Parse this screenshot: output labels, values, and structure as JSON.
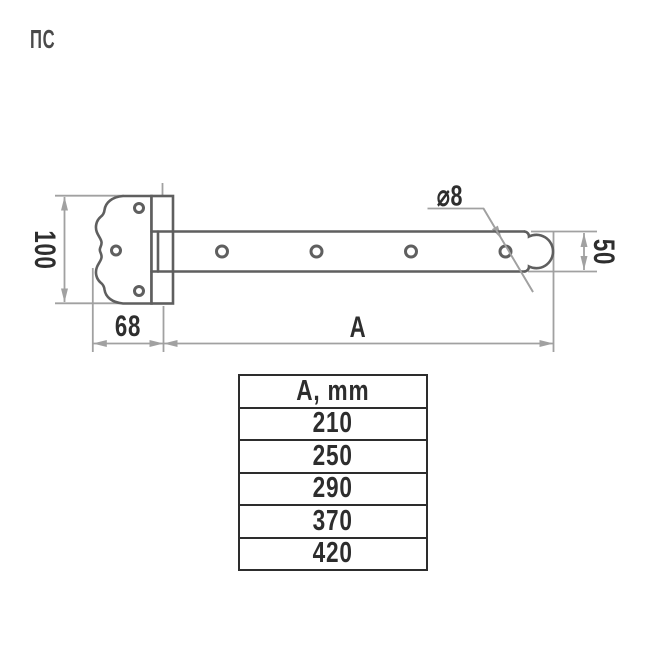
{
  "product_code": "ПС",
  "drawing": {
    "kind": "strap hinge technical drawing",
    "dimensions": {
      "plate_height": "100",
      "plate_width": "68",
      "strap_length_label": "А",
      "strap_width": "50",
      "hole_diameter": "⌀8"
    }
  },
  "table": {
    "header": "А, mm",
    "rows": [
      "210",
      "250",
      "290",
      "370",
      "420"
    ]
  },
  "colors": {
    "outline_gray": "#5f5f5f",
    "dimension_gray": "#a1a1a1",
    "text_dark": "#2e2e2e",
    "table_dark": "#2d2d2d",
    "background": "#ffffff"
  }
}
